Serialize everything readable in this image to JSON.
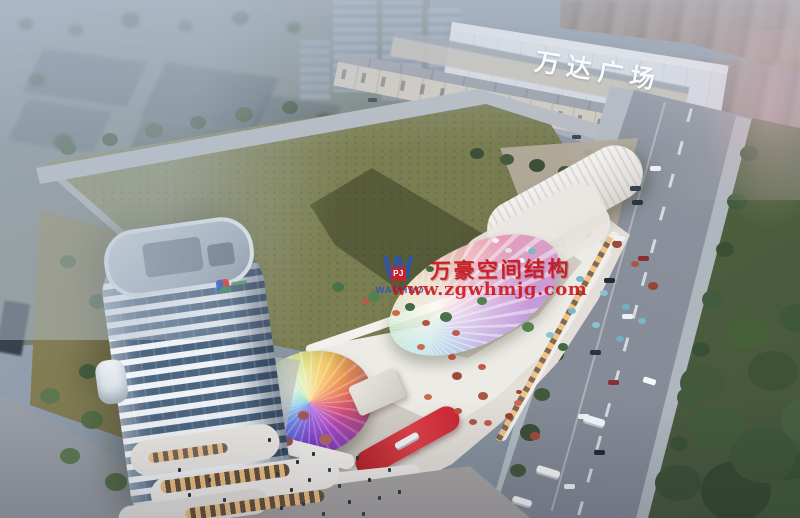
{
  "scene": {
    "kind": "aerial architectural rendering of a mixed-use commercial plaza",
    "signs": {
      "building_sign": "万达广场"
    },
    "watermark": {
      "logo_letter": "W",
      "logo_badge": "PJ",
      "logo_brand": "WANHAO",
      "title": "万豪空间结构",
      "url": "www.zgwhmjg.com"
    },
    "colors": {
      "watermark_red": "#c8121a",
      "watermark_blue": "#2454c8",
      "field_green": "#7f8254",
      "haze_blue": "#aebacc",
      "canopy_rainbow": [
        "#7b3fd4",
        "#3f63e0",
        "#37b6e0",
        "#43c98f",
        "#f5c84e",
        "#ef8a4a",
        "#e0526e",
        "#b04ad4"
      ]
    }
  }
}
